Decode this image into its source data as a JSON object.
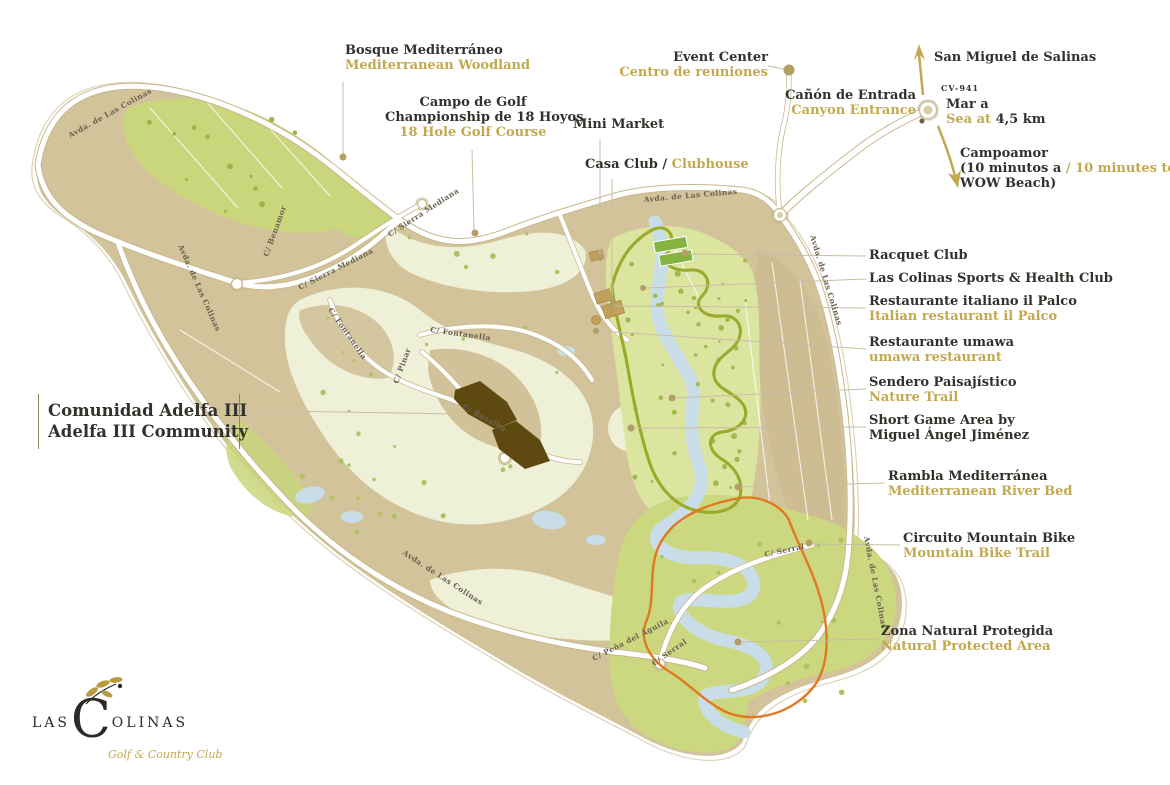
{
  "colors": {
    "ink": "#33312c",
    "gold": "#c2a94f",
    "orange": "#e0791f",
    "trail-green": "#9aab2c",
    "adelfa-brown": "#5e4a10",
    "land-tan": "#d2c39b",
    "woodland-green": "#c9d67c",
    "valley-green": "#dce59f",
    "protected-green": "#ccd87f",
    "river-blue": "#c9dde8",
    "road-casing": "#c6b98e",
    "leader": "#c5bfa5",
    "dot": "#b19f66",
    "street-ink": "#6b6250",
    "fairway-cream": "#eef0d8"
  },
  "callouts": {
    "bosque": {
      "es": "Bosque Mediterráneo",
      "en": "Mediterranean Woodland"
    },
    "campo": {
      "l1": "Campo de Golf",
      "l2": "Championship de 18 Hoyos",
      "en": "18 Hole Golf Course"
    },
    "mini_market": {
      "es": "Mini Market"
    },
    "casa_club": {
      "es": "Casa Club / ",
      "en": "Clubhouse"
    },
    "event": {
      "es": "Event Center",
      "en": "Centro de reuniones"
    },
    "canon": {
      "es": "Cañón de Entrada",
      "en": "Canyon Entrance"
    },
    "san_miguel": {
      "text": "San Miguel de Salinas"
    },
    "cv941": {
      "text": "CV-941"
    },
    "mar": {
      "es": "Mar a",
      "en": "Sea at ",
      "dist": "4,5 km"
    },
    "campoamor": {
      "l1": "Campoamor",
      "l2a": "(10 minutos a ",
      "l2b": "/ 10 minutes to",
      "l3": "WOW Beach)"
    },
    "racquet": {
      "text": "Racquet Club"
    },
    "sports": {
      "text": "Las Colinas Sports & Health Club"
    },
    "palco": {
      "es": "Restaurante italiano il Palco",
      "en": "Italian restaurant il Palco"
    },
    "umawa": {
      "es": "Restaurante umawa",
      "en": "umawa restaurant"
    },
    "sendero": {
      "es": "Sendero Paisajístico",
      "en": "Nature Trail"
    },
    "short_game": {
      "l1": "Short Game Area by",
      "l2": "Miguel Ángel Jiménez"
    },
    "rambla": {
      "es": "Rambla Mediterránea",
      "en": "Mediterranean River Bed"
    },
    "mtb": {
      "es": "Circuito Mountain Bike",
      "en": "Mountain Bike Trail"
    },
    "zona": {
      "es": "Zona Natural Protegida",
      "en": "Natural Protected Area"
    },
    "adelfa": {
      "es": "Comunidad Adelfa III",
      "en": "Adelfa III Community"
    }
  },
  "streets": {
    "avda": "Avda. de Las Colinas",
    "sierra": "C/ Sierra Mediana",
    "benamor": "C/ Benamor",
    "fontanella": "C/ Fontanella",
    "pinar": "C/ Pinar",
    "rosalba": "C/ Rosalba",
    "serral": "C/ Serral",
    "aguila": "C/ Peña del Águila"
  },
  "logo": {
    "las": "LAS",
    "c": "C",
    "olinas": "OLINAS",
    "sub": "Golf & Country Club"
  }
}
